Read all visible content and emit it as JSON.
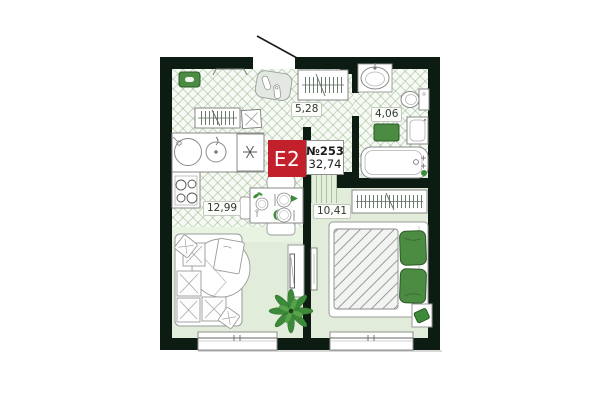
{
  "plan": {
    "badge": {
      "layout_label": "E2",
      "unit_number": "№253",
      "total_area": "32,74"
    },
    "rooms": [
      {
        "name": "hallway",
        "area_label": "5,28"
      },
      {
        "name": "bathroom",
        "area_label": "4,06"
      },
      {
        "name": "kitchen-living-room",
        "area_label": "12,99"
      },
      {
        "name": "bedroom",
        "area_label": "10,41"
      }
    ],
    "colors": {
      "wall": "#0d1c12",
      "badge_red": "#c2212b",
      "accent_green": "#4c8b42",
      "floor_plain": "#e1edda",
      "tile_background": "#f7faf4"
    },
    "icons": [
      "entrance-door-swing",
      "doormat",
      "coat-rail",
      "shoe-bench",
      "hall-wardrobe",
      "stool",
      "kitchen-sink",
      "kettle",
      "hob",
      "stove",
      "dining-table",
      "chair",
      "plate",
      "corner-sofa",
      "pillow",
      "blanket",
      "round-rug",
      "tv-stand",
      "plant",
      "bed",
      "bed-pillow",
      "bedroom-wardrobe",
      "bedside-table",
      "pouf",
      "washbasin",
      "toilet",
      "washing-machine",
      "bath-mat",
      "bathtub",
      "window"
    ]
  }
}
